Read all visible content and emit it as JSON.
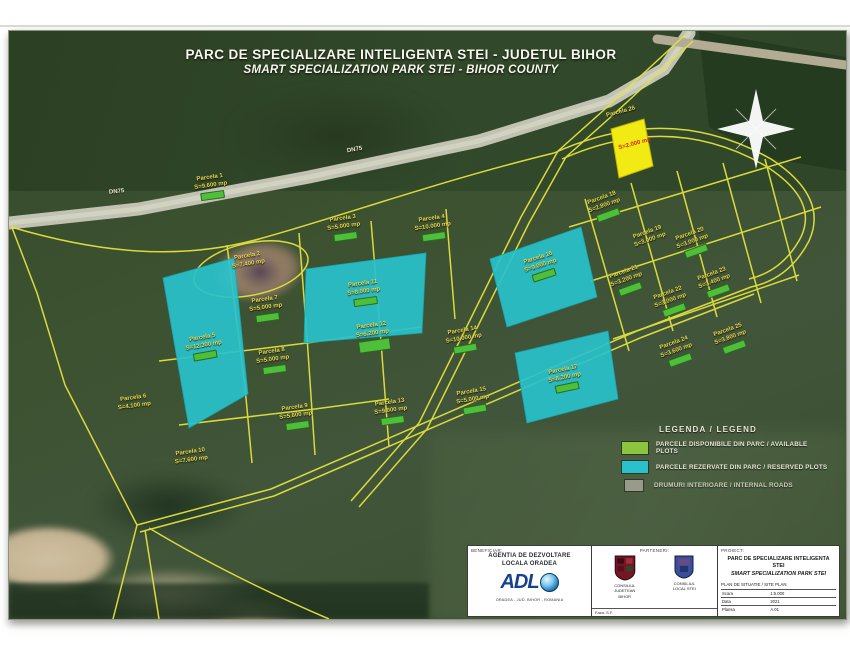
{
  "title": {
    "line1": "PARC DE SPECIALIZARE INTELIGENTA STEI - JUDETUL BIHOR",
    "line2": "SMART SPECIALIZATION PARK STEI - BIHOR COUNTY"
  },
  "colors": {
    "available_green": "#8cc63f",
    "reserved_cyan": "#29c2cc",
    "highlight_yellow": "#f2ea13",
    "boundary_yellow": "#e3e23e",
    "badge_green": "#4fbe3a"
  },
  "road_labels": [
    {
      "text": "DN75",
      "x": 100,
      "y": 158,
      "r": -6,
      "cls": ""
    },
    {
      "text": "DN75",
      "x": 338,
      "y": 116,
      "r": -10,
      "cls": ""
    },
    {
      "text": "DJ763",
      "x": 52,
      "y": 570,
      "r": 0,
      "cls": "dark"
    }
  ],
  "parcels": [
    {
      "l1": "Parcela 1",
      "l2": "S=9.600 mp",
      "x": 202,
      "y": 156,
      "r": -8,
      "b": true,
      "cls": ""
    },
    {
      "l1": "Parcela 2",
      "l2": "S=7.400 mp",
      "x": 239,
      "y": 230,
      "r": -10,
      "b": false,
      "cls": ""
    },
    {
      "l1": "Parcela 3",
      "l2": "S=5.000 mp",
      "x": 335,
      "y": 197,
      "r": -8,
      "b": true,
      "cls": ""
    },
    {
      "l1": "Parcela 4",
      "l2": "S=10.000 mp",
      "x": 424,
      "y": 197,
      "r": -8,
      "b": true,
      "cls": ""
    },
    {
      "l1": "Parcela 5",
      "l2": "S=12.300 mp",
      "x": 195,
      "y": 316,
      "r": -10,
      "b": true,
      "cls": ""
    },
    {
      "l1": "Parcela 6",
      "l2": "S=4.100 mp",
      "x": 125,
      "y": 372,
      "r": -8,
      "b": false,
      "cls": ""
    },
    {
      "l1": "Parcela 7",
      "l2": "S=5.000 mp",
      "x": 257,
      "y": 278,
      "r": -8,
      "b": true,
      "cls": ""
    },
    {
      "l1": "Parcela 8",
      "l2": "S=5.000 mp",
      "x": 264,
      "y": 330,
      "r": -8,
      "b": true,
      "cls": ""
    },
    {
      "l1": "Parcela 9",
      "l2": "S=5.600 mp",
      "x": 287,
      "y": 386,
      "r": -8,
      "b": true,
      "cls": ""
    },
    {
      "l1": "Parcela 10",
      "l2": "S=7.600 mp",
      "x": 182,
      "y": 426,
      "r": -8,
      "b": false,
      "cls": ""
    },
    {
      "l1": "Parcela 11",
      "l2": "S=8.000 mp",
      "x": 355,
      "y": 262,
      "r": -8,
      "b": true,
      "cls": ""
    },
    {
      "l1": "Parcela 12",
      "l2": "S=6.200 mp",
      "x": 364,
      "y": 306,
      "r": -8,
      "b": true,
      "cls": "big-badge"
    },
    {
      "l1": "Parcela 13",
      "l2": "S=9.000 mp",
      "x": 382,
      "y": 381,
      "r": -8,
      "b": true,
      "cls": ""
    },
    {
      "l1": "Parcela 14",
      "l2": "S=10.000 mp",
      "x": 455,
      "y": 309,
      "r": -10,
      "b": true,
      "cls": ""
    },
    {
      "l1": "Parcela 15",
      "l2": "S=5.000 mp",
      "x": 464,
      "y": 370,
      "r": -10,
      "b": true,
      "cls": ""
    },
    {
      "l1": "Parcela 16",
      "l2": "S=9.000 mp",
      "x": 532,
      "y": 236,
      "r": -18,
      "b": true,
      "cls": ""
    },
    {
      "l1": "Parcela 17",
      "l2": "S=8.200 mp",
      "x": 556,
      "y": 348,
      "r": -12,
      "b": true,
      "cls": ""
    },
    {
      "l1": "Parcela 18",
      "l2": "S=2.800 mp",
      "x": 596,
      "y": 176,
      "r": -20,
      "b": true,
      "cls": ""
    },
    {
      "l1": "Parcela 19",
      "l2": "S=3.000 mp",
      "x": 640,
      "y": 206,
      "r": -20,
      "b": false,
      "cls": ""
    },
    {
      "l1": "Parcela 20",
      "l2": "S=3.000 mp",
      "x": 684,
      "y": 212,
      "r": -20,
      "b": true,
      "cls": ""
    },
    {
      "l1": "Parcela 21",
      "l2": "S=3.200 mp",
      "x": 618,
      "y": 250,
      "r": -20,
      "b": true,
      "cls": ""
    },
    {
      "l1": "Parcela 22",
      "l2": "S=3.000 mp",
      "x": 662,
      "y": 271,
      "r": -20,
      "b": true,
      "cls": ""
    },
    {
      "l1": "Parcela 23",
      "l2": "S=3.400 mp",
      "x": 706,
      "y": 252,
      "r": -20,
      "b": true,
      "cls": ""
    },
    {
      "l1": "Parcela 24",
      "l2": "S=3.600 mp",
      "x": 668,
      "y": 321,
      "r": -20,
      "b": true,
      "cls": ""
    },
    {
      "l1": "Parcela 25",
      "l2": "S=3.800 mp",
      "x": 722,
      "y": 308,
      "r": -20,
      "b": true,
      "cls": ""
    },
    {
      "l1": "Parcela 26",
      "l2": "",
      "x": 612,
      "y": 82,
      "r": -15,
      "b": false,
      "cls": ""
    },
    {
      "l1": "S=2.000 mp",
      "l2": "",
      "x": 626,
      "y": 114,
      "r": -15,
      "b": false,
      "cls": "red"
    }
  ],
  "legend": {
    "title": "LEGENDA / LEGEND",
    "items": [
      {
        "label": "PARCELE DISPONIBILE DIN PARC / AVAILABLE PLOTS"
      },
      {
        "label": "PARCELE REZERVATE DIN PARC / RESERVED PLOTS"
      },
      {
        "label": "DRUMURI INTERIOARE / INTERNAL ROADS"
      }
    ]
  },
  "title_block": {
    "beneficiary": {
      "label": "BENEFICIAR:",
      "line1": "AGENTIA DE DEZVOLTARE",
      "line2": "LOCALA ORADEA",
      "logo_letters": "ADL",
      "footer": "ORADEA - JUD. BIHOR - ROMANIA"
    },
    "partners": {
      "label": "PARTENERI:",
      "shield1_line1": "CONSILIUL",
      "shield1_line2": "JUDETEAN",
      "shield1_line3": "BIHOR",
      "shield2_line1": "CONSILIUL",
      "shield2_line2": "LOCAL STEI",
      "footer": "Faza: S.F."
    },
    "project": {
      "label": "PROIECT:",
      "line1": "PARC DE SPECIALIZARE INTELIGENTA STEI",
      "line2": "SMART SPECIALIZATION PARK STEI",
      "sub": "PLAN DE SITUATIE / SITE PLAN",
      "rows": [
        [
          "Scara",
          "1:5.000"
        ],
        [
          "Data",
          "2021"
        ],
        [
          "Plansa",
          "A.01"
        ]
      ]
    }
  }
}
